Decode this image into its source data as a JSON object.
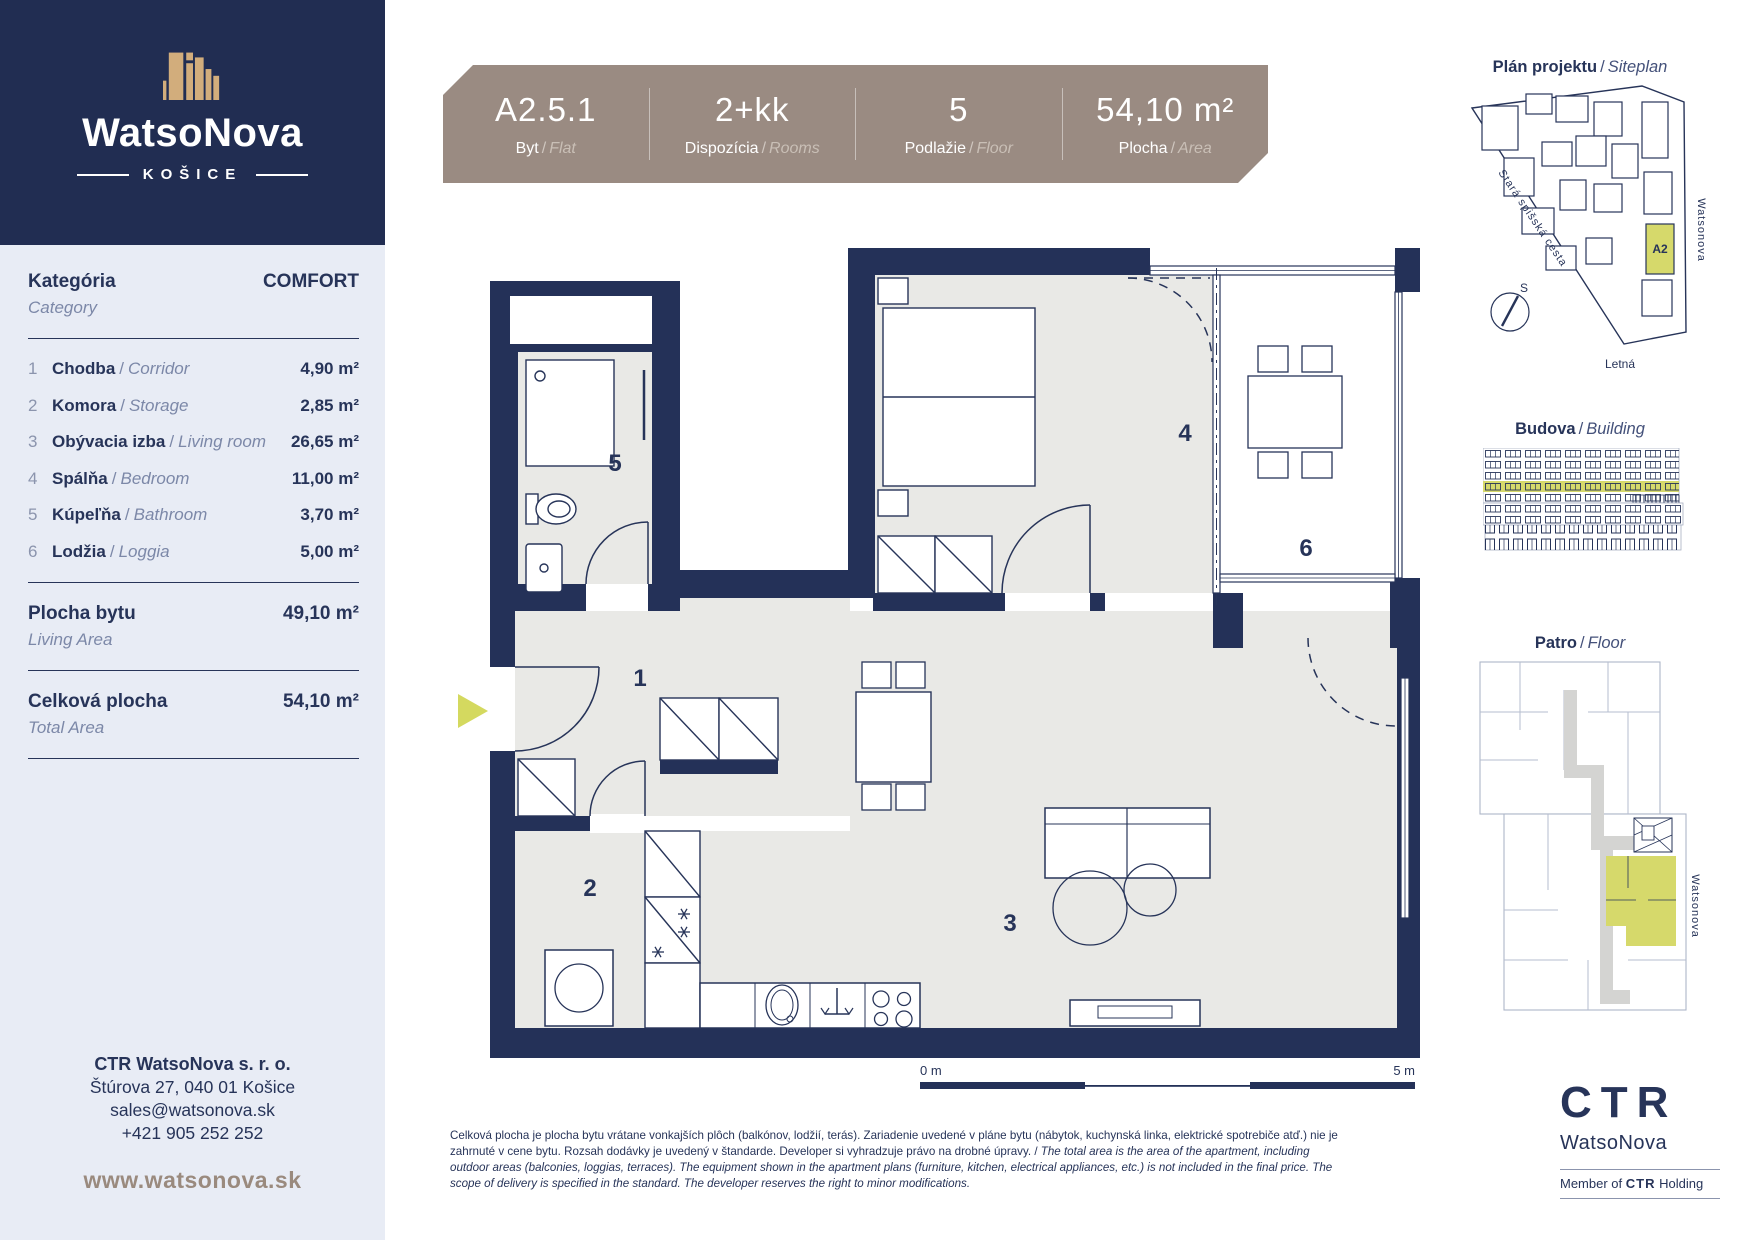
{
  "sep": "/",
  "brand": {
    "name": "WatsoNova",
    "city": "KOŠICE"
  },
  "category": {
    "label_sk": "Kategória",
    "label_en": "Category",
    "value": "COMFORT"
  },
  "rooms": [
    {
      "num": "1",
      "sk": "Chodba",
      "en": "Corridor",
      "area": "4,90 m²"
    },
    {
      "num": "2",
      "sk": "Komora",
      "en": "Storage",
      "area": "2,85 m²"
    },
    {
      "num": "3",
      "sk": "Obývacia izba",
      "en": "Living room",
      "area": "26,65 m²"
    },
    {
      "num": "4",
      "sk": "Spálňa",
      "en": "Bedroom",
      "area": "11,00 m²"
    },
    {
      "num": "5",
      "sk": "Kúpeľňa",
      "en": "Bathroom",
      "area": "3,70 m²"
    },
    {
      "num": "6",
      "sk": "Lodžia",
      "en": "Loggia",
      "area": "5,00 m²"
    }
  ],
  "summary": {
    "living": {
      "sk": "Plocha bytu",
      "en": "Living Area",
      "value": "49,10 m²"
    },
    "total": {
      "sk": "Celková plocha",
      "en": "Total Area",
      "value": "54,10 m²"
    }
  },
  "contact": {
    "company": "CTR WatsoNova s. r. o.",
    "address": "Štúrova 27, 040 01  Košice",
    "email": "sales@watsonova.sk",
    "phone": "+421 905 252 252",
    "website": "www.watsonova.sk"
  },
  "header": {
    "cells": [
      {
        "value": "A2.5.1",
        "label_sk": "Byt",
        "label_en": "Flat"
      },
      {
        "value": "2+kk",
        "label_sk": "Dispozícia",
        "label_en": "Rooms"
      },
      {
        "value": "5",
        "label_sk": "Podlažie",
        "label_en": "Floor"
      },
      {
        "value": "54,10 m²",
        "label_sk": "Plocha",
        "label_en": "Area"
      }
    ]
  },
  "plan": {
    "labels": {
      "corridor": "1",
      "storage": "2",
      "living": "3",
      "bedroom": "4",
      "bathroom": "5",
      "loggia": "6"
    },
    "scale": {
      "start": "0 m",
      "end": "5 m"
    }
  },
  "siteplan": {
    "title_sk": "Plán projektu",
    "title_en": "Siteplan",
    "street_left": "Stará spišská cesta",
    "street_right": "Watsonova",
    "street_bottom": "Letná",
    "unit": "A2",
    "compass": "S"
  },
  "building": {
    "title_sk": "Budova",
    "title_en": "Building"
  },
  "floor": {
    "title_sk": "Patro",
    "title_en": "Floor",
    "street": "Watsonova"
  },
  "disclaimer": {
    "sk": "Celková plocha je plocha bytu vrátane vonkajších plôch (balkónov, lodžií, terás). Zariadenie uvedené v pláne bytu (nábytok, kuchynská linka, elektrické spotrebiče atď.) nie je zahrnuté v cene bytu. Rozsah dodávky je uvedený v štandarde. Developer si vyhradzuje právo na drobné úpravy. / ",
    "en": "The total area is the area of the apartment, including outdoor areas (balconies, loggias, terraces). The equipment shown in the apartment plans (furniture, kitchen, electrical appliances, etc.) is not included in the final price. The scope of delivery is specified in the standard. The developer reserves the right to minor modifications."
  },
  "ctr": {
    "logo": "CTR",
    "name": "WatsoNova",
    "member": "Member of",
    "holding": "CTR",
    "holding_word": "Holding"
  },
  "colors": {
    "navy": "#243158",
    "taupe": "#9a8b82",
    "tan": "#d2ad7c",
    "highlight": "#d6d96b",
    "panel": "#e8ecf5"
  }
}
